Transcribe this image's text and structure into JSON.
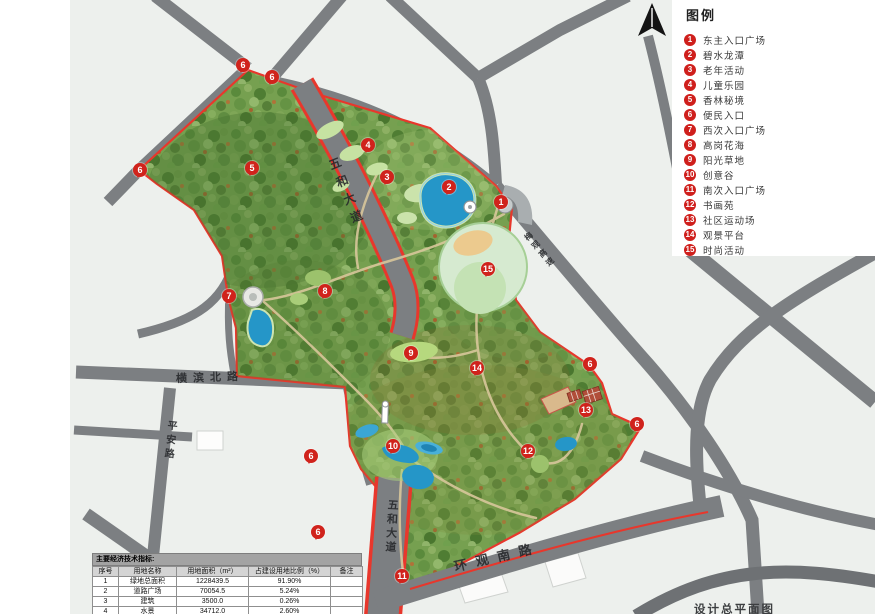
{
  "plan_label": "设计总平面图",
  "legend": {
    "title": "图例",
    "items": [
      {
        "num": "1",
        "label": "东主入口广场"
      },
      {
        "num": "2",
        "label": "碧水龙潭"
      },
      {
        "num": "3",
        "label": "老年活动"
      },
      {
        "num": "4",
        "label": "儿童乐园"
      },
      {
        "num": "5",
        "label": "香林秘境"
      },
      {
        "num": "6",
        "label": "便民入口"
      },
      {
        "num": "7",
        "label": "西次入口广场"
      },
      {
        "num": "8",
        "label": "高岗花海"
      },
      {
        "num": "9",
        "label": "阳光草地"
      },
      {
        "num": "10",
        "label": "创意谷"
      },
      {
        "num": "11",
        "label": "南次入口广场"
      },
      {
        "num": "12",
        "label": "书画苑"
      },
      {
        "num": "13",
        "label": "社区运动场"
      },
      {
        "num": "14",
        "label": "观景平台"
      },
      {
        "num": "15",
        "label": "时尚活动"
      }
    ]
  },
  "table": {
    "title": "主要经济技术指标:",
    "columns": [
      "序号",
      "用地名称",
      "用地面积（m²）",
      "占建设用地比例（%）",
      "备注"
    ],
    "rows": [
      [
        "1",
        "绿地总面积",
        "1228439.5",
        "91.90%",
        ""
      ],
      [
        "2",
        "道路广场",
        "70054.5",
        "5.24%",
        ""
      ],
      [
        "3",
        "建筑",
        "3500.0",
        "0.26%",
        ""
      ],
      [
        "4",
        "水景",
        "34712.0",
        "2.60%",
        ""
      ],
      [
        "",
        "合计",
        "1336706",
        "100",
        ""
      ]
    ]
  },
  "map": {
    "colors": {
      "boundary": "#e8372c",
      "marker": "#d0231c",
      "road": "#7c7f82",
      "water": "#2596c8",
      "park_green": "#76a050"
    },
    "road_labels": [
      {
        "text": "横滨北路",
        "x": 210,
        "y": 377,
        "rot": -2,
        "vertical": false,
        "size": 11,
        "spacing": 6
      },
      {
        "text": "平安路",
        "x": 169,
        "y": 441,
        "rot": 6,
        "vertical": true,
        "size": 10,
        "spacing": 4
      },
      {
        "text": "五和大道",
        "x": 347,
        "y": 193,
        "rot": -22,
        "vertical": true,
        "size": 12,
        "spacing": 7
      },
      {
        "text": "梅观高速",
        "x": 540,
        "y": 250,
        "rot": -40,
        "vertical": true,
        "size": 8,
        "spacing": 3
      },
      {
        "text": "五和大道",
        "x": 391,
        "y": 527,
        "rot": 3,
        "vertical": true,
        "size": 11,
        "spacing": 3
      },
      {
        "text": "环观南路",
        "x": 497,
        "y": 556,
        "rot": -13,
        "vertical": false,
        "size": 13,
        "spacing": 9
      }
    ],
    "markers": [
      {
        "n": "1",
        "x": 501,
        "y": 202
      },
      {
        "n": "2",
        "x": 449,
        "y": 187
      },
      {
        "n": "3",
        "x": 387,
        "y": 177
      },
      {
        "n": "4",
        "x": 368,
        "y": 145
      },
      {
        "n": "5",
        "x": 252,
        "y": 168
      },
      {
        "n": "6",
        "x": 243,
        "y": 65
      },
      {
        "n": "6",
        "x": 272,
        "y": 77
      },
      {
        "n": "6",
        "x": 140,
        "y": 170
      },
      {
        "n": "6",
        "x": 590,
        "y": 364
      },
      {
        "n": "6",
        "x": 637,
        "y": 424
      },
      {
        "n": "6",
        "x": 311,
        "y": 456
      },
      {
        "n": "6",
        "x": 318,
        "y": 532
      },
      {
        "n": "7",
        "x": 229,
        "y": 296
      },
      {
        "n": "8",
        "x": 325,
        "y": 291
      },
      {
        "n": "9",
        "x": 411,
        "y": 353
      },
      {
        "n": "10",
        "x": 393,
        "y": 446
      },
      {
        "n": "11",
        "x": 402,
        "y": 576
      },
      {
        "n": "12",
        "x": 528,
        "y": 451
      },
      {
        "n": "13",
        "x": 586,
        "y": 410
      },
      {
        "n": "14",
        "x": 477,
        "y": 368
      },
      {
        "n": "15",
        "x": 488,
        "y": 269
      }
    ]
  }
}
